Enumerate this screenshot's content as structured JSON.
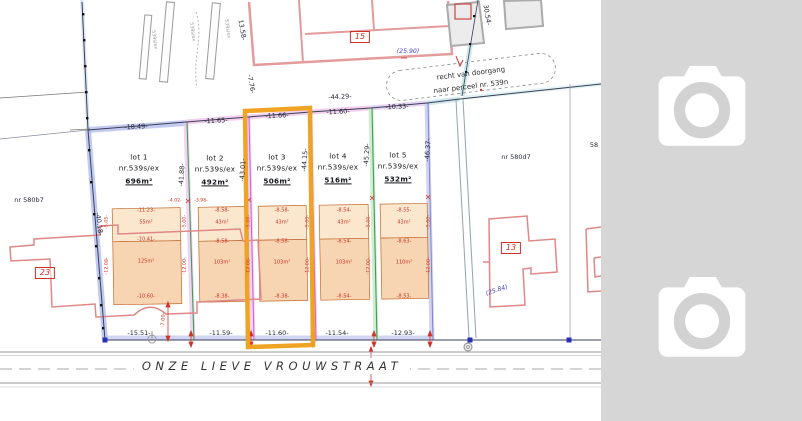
{
  "street": {
    "name": "ONZE LIEVE VROUWSTRAAT"
  },
  "panel": {
    "background": "#d6d6d6",
    "placeholder_icon": "camera-icon",
    "placeholder_count": 2
  },
  "highlight": {
    "color": "#f0a11c",
    "target": "lot 3"
  },
  "right_of_way": {
    "line1": "recht van doorgang",
    "line2": "naar perceel nr. 539n"
  },
  "neighbors": {
    "left_parcel": "nr 580b7",
    "right_parcel": "nr 580d7",
    "clipped_parcel": "58",
    "house_numbers": [
      "15",
      "23",
      "13"
    ]
  },
  "notes_blue": [
    "(25.90)",
    "(25.84)"
  ],
  "lots": [
    {
      "label": "lot 1",
      "parcel": "nr.539s/ex",
      "area": "696m²",
      "front_top": "-18.49-",
      "front_bottom": "-15.51-",
      "side": "-41.88-",
      "build_upper_width": "-11.23-",
      "build_upper_area": "55m²",
      "build_mid_width": "-10.41-",
      "build_main_area": "125m²",
      "build_bottom_width": "-10.60-"
    },
    {
      "label": "lot 2",
      "parcel": "nr.539s/ex",
      "area": "492m²",
      "front_top": "-11.65-",
      "front_bottom": "-11.59-",
      "side": "-43.01-",
      "build_upper_width": "-8.58-",
      "build_upper_area": "43m²",
      "build_mid_width": "-8.58-",
      "build_main_area": "103m²",
      "build_bottom_width": "-8.38-"
    },
    {
      "label": "lot 3",
      "parcel": "nr.539s/ex",
      "area": "506m²",
      "front_top": "-11.66-",
      "front_bottom": "-11.60-",
      "side": "-44.15-",
      "build_upper_width": "-8.58-",
      "build_upper_area": "43m²",
      "build_mid_width": "-8.58-",
      "build_main_area": "103m²",
      "build_bottom_width": "-8.38-",
      "highlighted": true
    },
    {
      "label": "lot 4",
      "parcel": "nr.539s/ex",
      "area": "516m²",
      "front_top": "-11.60-",
      "front_bottom": "-11.54-",
      "side": "-45.29-",
      "build_upper_width": "-8.54-",
      "build_upper_area": "43m²",
      "build_mid_width": "-8.54-",
      "build_main_area": "103m²",
      "build_bottom_width": "-8.54-"
    },
    {
      "label": "lot 5",
      "parcel": "nr.539s/ex",
      "area": "532m²",
      "front_top": "-10.33-",
      "front_bottom": "-12.93-",
      "side": "-46.37-",
      "build_upper_width": "-8.55-",
      "build_upper_area": "43m²",
      "build_mid_width": "-8.63-",
      "build_main_area": "110m²",
      "build_bottom_width": "-8.53-"
    }
  ],
  "boundary_dims": [
    "-44.29-",
    "-40.18-",
    "13.58-",
    "-7.76-",
    "30.54-"
  ],
  "plan": {
    "labels": [
      {
        "id": "dim-top-lot1",
        "t": "-18.49-",
        "x": 136,
        "y": 127,
        "s": 6.5,
        "c": "dim",
        "r": -3
      },
      {
        "id": "dim-top-lot2",
        "t": "-11.65-",
        "x": 216,
        "y": 121,
        "s": 6.5,
        "c": "dim",
        "r": -3
      },
      {
        "id": "dim-top-lot3",
        "t": "-11.66-",
        "x": 277,
        "y": 116,
        "s": 6.5,
        "c": "dim",
        "r": -3
      },
      {
        "id": "dim-top-lot4",
        "t": "-11.60-",
        "x": 338,
        "y": 112,
        "s": 6.5,
        "c": "dim",
        "r": -3
      },
      {
        "id": "dim-top-lot5",
        "t": "-10.33-",
        "x": 397,
        "y": 107,
        "s": 6.5,
        "c": "dim",
        "r": -3
      },
      {
        "id": "dim-top-total",
        "t": "-44.29-",
        "x": 340,
        "y": 97,
        "s": 6.5,
        "c": "dim",
        "r": -3
      },
      {
        "id": "dim-bottom-lot1",
        "t": "-15.51-",
        "x": 139,
        "y": 333,
        "s": 6.5,
        "c": "dim"
      },
      {
        "id": "dim-bottom-lot2",
        "t": "-11.59-",
        "x": 221,
        "y": 333,
        "s": 6.5,
        "c": "dim"
      },
      {
        "id": "dim-bottom-lot3",
        "t": "-11.60-",
        "x": 277,
        "y": 333,
        "s": 6.5,
        "c": "dim"
      },
      {
        "id": "dim-bottom-lot4",
        "t": "-11.54-",
        "x": 337,
        "y": 333,
        "s": 6.5,
        "c": "dim"
      },
      {
        "id": "dim-bottom-lot5",
        "t": "-12.93-",
        "x": 403,
        "y": 333,
        "s": 6.5,
        "c": "dim"
      },
      {
        "id": "dim-side-west",
        "t": "-40.18-",
        "x": 99,
        "y": 224,
        "s": 6.5,
        "c": "dim",
        "r": 82
      },
      {
        "id": "dim-side-d1",
        "t": "-41.88-",
        "x": 182,
        "y": 175,
        "s": 6.5,
        "c": "dim",
        "r": -86
      },
      {
        "id": "dim-side-d2",
        "t": "-43.01-",
        "x": 243,
        "y": 170,
        "s": 6.5,
        "c": "dim",
        "r": -86
      },
      {
        "id": "dim-side-d3",
        "t": "-44.15-",
        "x": 305,
        "y": 160,
        "s": 6.5,
        "c": "dim",
        "r": -86
      },
      {
        "id": "dim-side-d4",
        "t": "-45.29-",
        "x": 367,
        "y": 155,
        "s": 6.5,
        "c": "dim",
        "r": -86
      },
      {
        "id": "dim-side-d5",
        "t": "-46.37-",
        "x": 428,
        "y": 150,
        "s": 6.5,
        "c": "dim",
        "r": -86
      },
      {
        "id": "dim-ne-1",
        "t": "13.58-",
        "x": 242,
        "y": 30,
        "s": 6.5,
        "c": "dim",
        "r": 80
      },
      {
        "id": "dim-ne-2",
        "t": "-7.76-",
        "x": 251,
        "y": 84,
        "s": 6.5,
        "c": "dim",
        "r": 80
      },
      {
        "id": "dim-ne-3",
        "t": "30.54-",
        "x": 487,
        "y": 15,
        "s": 6.5,
        "c": "dim",
        "r": 80
      },
      {
        "id": "lot1-name",
        "t": "lot 1",
        "x": 139,
        "y": 157,
        "s": 7.2,
        "c": "lot"
      },
      {
        "id": "lot1-parcel",
        "t": "nr.539s/ex",
        "x": 139,
        "y": 168,
        "s": 7.2,
        "c": "lot"
      },
      {
        "id": "lot1-area",
        "t": "696m²",
        "x": 139,
        "y": 181,
        "s": 7.2,
        "c": "area"
      },
      {
        "id": "lot2-name",
        "t": "lot 2",
        "x": 215,
        "y": 158,
        "s": 7.2,
        "c": "lot"
      },
      {
        "id": "lot2-parcel",
        "t": "nr.539s/ex",
        "x": 215,
        "y": 169,
        "s": 7.2,
        "c": "lot"
      },
      {
        "id": "lot2-area",
        "t": "492m²",
        "x": 215,
        "y": 182,
        "s": 7.2,
        "c": "area"
      },
      {
        "id": "lot3-name",
        "t": "lot 3",
        "x": 277,
        "y": 157,
        "s": 7.2,
        "c": "lot"
      },
      {
        "id": "lot3-parcel",
        "t": "nr.539s/ex",
        "x": 277,
        "y": 168,
        "s": 7.2,
        "c": "lot"
      },
      {
        "id": "lot3-area",
        "t": "506m²",
        "x": 277,
        "y": 181,
        "s": 7.2,
        "c": "area"
      },
      {
        "id": "lot4-name",
        "t": "lot 4",
        "x": 338,
        "y": 156,
        "s": 7.2,
        "c": "lot"
      },
      {
        "id": "lot4-parcel",
        "t": "nr.539s/ex",
        "x": 338,
        "y": 167,
        "s": 7.2,
        "c": "lot"
      },
      {
        "id": "lot4-area",
        "t": "516m²",
        "x": 338,
        "y": 180,
        "s": 7.2,
        "c": "area"
      },
      {
        "id": "lot5-name",
        "t": "lot 5",
        "x": 398,
        "y": 155,
        "s": 7.2,
        "c": "lot"
      },
      {
        "id": "lot5-parcel",
        "t": "nr.539s/ex",
        "x": 398,
        "y": 166,
        "s": 7.2,
        "c": "lot"
      },
      {
        "id": "lot5-area",
        "t": "532m²",
        "x": 398,
        "y": 179,
        "s": 7.2,
        "c": "area"
      },
      {
        "id": "parcel-580b7",
        "t": "nr 580b7",
        "x": 29,
        "y": 200,
        "s": 6.5,
        "c": "dim"
      },
      {
        "id": "parcel-580d7",
        "t": "nr 580d7",
        "x": 516,
        "y": 157,
        "s": 6.5,
        "c": "dim"
      },
      {
        "id": "parcel-clipped",
        "t": "58",
        "x": 594,
        "y": 145,
        "s": 6.5,
        "c": "dim"
      },
      {
        "id": "house-15",
        "t": "15",
        "x": 360,
        "y": 37,
        "s": 8,
        "c": "box"
      },
      {
        "id": "house-23",
        "t": "23",
        "x": 45,
        "y": 273,
        "s": 8,
        "c": "box"
      },
      {
        "id": "house-13",
        "t": "13",
        "x": 511,
        "y": 248,
        "s": 8,
        "c": "box"
      },
      {
        "id": "note-2590",
        "t": "(25.90)",
        "x": 408,
        "y": 52,
        "s": 6.2,
        "c": "blue"
      },
      {
        "id": "note-2584",
        "t": "(25.84)",
        "x": 497,
        "y": 291,
        "s": 6.2,
        "c": "blue",
        "r": -18
      },
      {
        "id": "row-line1",
        "t": "recht van doorgang",
        "x": 471,
        "y": 74,
        "s": 7,
        "c": "row",
        "r": -7
      },
      {
        "id": "row-line2",
        "t": "naar perceel nr. 539n",
        "x": 471,
        "y": 87,
        "s": 7,
        "c": "row",
        "r": -7
      },
      {
        "id": "fp1-top",
        "t": "-11.23-",
        "x": 146,
        "y": 211,
        "s": 5,
        "c": "red"
      },
      {
        "id": "fp1-area-top",
        "t": "55m²",
        "x": 146,
        "y": 223,
        "s": 5,
        "c": "red"
      },
      {
        "id": "fp1-mid",
        "t": "-10.41-",
        "x": 146,
        "y": 240,
        "s": 5,
        "c": "red"
      },
      {
        "id": "fp1-area-main",
        "t": "125m²",
        "x": 146,
        "y": 262,
        "s": 5,
        "c": "red"
      },
      {
        "id": "fp1-bottom",
        "t": "-10.60-",
        "x": 146,
        "y": 297,
        "s": 5,
        "c": "red"
      },
      {
        "id": "fp2-top",
        "t": "-8.58-",
        "x": 222,
        "y": 211,
        "s": 5,
        "c": "red"
      },
      {
        "id": "fp2-area-top",
        "t": "43m²",
        "x": 222,
        "y": 223,
        "s": 5,
        "c": "red"
      },
      {
        "id": "fp2-mid",
        "t": "-8.58-",
        "x": 222,
        "y": 242,
        "s": 5,
        "c": "red"
      },
      {
        "id": "fp2-area-main",
        "t": "103m²",
        "x": 222,
        "y": 263,
        "s": 5,
        "c": "red"
      },
      {
        "id": "fp2-bottom",
        "t": "-8.38-",
        "x": 222,
        "y": 297,
        "s": 5,
        "c": "red"
      },
      {
        "id": "fp3-top",
        "t": "-8.58-",
        "x": 282,
        "y": 211,
        "s": 5,
        "c": "red"
      },
      {
        "id": "fp3-area-top",
        "t": "43m²",
        "x": 282,
        "y": 223,
        "s": 5,
        "c": "red"
      },
      {
        "id": "fp3-mid",
        "t": "-8.58-",
        "x": 282,
        "y": 242,
        "s": 5,
        "c": "red"
      },
      {
        "id": "fp3-area-main",
        "t": "103m²",
        "x": 282,
        "y": 263,
        "s": 5,
        "c": "red"
      },
      {
        "id": "fp3-bottom",
        "t": "-8.38-",
        "x": 282,
        "y": 297,
        "s": 5,
        "c": "red"
      },
      {
        "id": "fp4-top",
        "t": "-8.54-",
        "x": 344,
        "y": 211,
        "s": 5,
        "c": "red"
      },
      {
        "id": "fp4-area-top",
        "t": "43m²",
        "x": 344,
        "y": 223,
        "s": 5,
        "c": "red"
      },
      {
        "id": "fp4-mid",
        "t": "-8.54-",
        "x": 344,
        "y": 242,
        "s": 5,
        "c": "red"
      },
      {
        "id": "fp4-area-main",
        "t": "103m²",
        "x": 344,
        "y": 263,
        "s": 5,
        "c": "red"
      },
      {
        "id": "fp4-bottom",
        "t": "-8.54-",
        "x": 344,
        "y": 297,
        "s": 5,
        "c": "red"
      },
      {
        "id": "fp5-top",
        "t": "-8.55-",
        "x": 404,
        "y": 211,
        "s": 5,
        "c": "red"
      },
      {
        "id": "fp5-area-top",
        "t": "43m²",
        "x": 404,
        "y": 223,
        "s": 5,
        "c": "red"
      },
      {
        "id": "fp5-mid",
        "t": "-8.63-",
        "x": 404,
        "y": 242,
        "s": 5,
        "c": "red"
      },
      {
        "id": "fp5-area-main",
        "t": "110m²",
        "x": 404,
        "y": 263,
        "s": 5,
        "c": "red"
      },
      {
        "id": "fp5-bottom",
        "t": "-8.53-",
        "x": 404,
        "y": 297,
        "s": 5,
        "c": "red"
      },
      {
        "id": "fp1-side-l1",
        "t": "-5.05-",
        "x": 108,
        "y": 222,
        "s": 4.8,
        "c": "red",
        "r": -88
      },
      {
        "id": "fp1-side-l2",
        "t": "-12.08-",
        "x": 108,
        "y": 266,
        "s": 4.8,
        "c": "red",
        "r": -88
      },
      {
        "id": "fp1-side-r1",
        "t": "-5.00-",
        "x": 186,
        "y": 222,
        "s": 4.8,
        "c": "red",
        "r": -88
      },
      {
        "id": "fp1-side-r2",
        "t": "-12.00-",
        "x": 186,
        "y": 266,
        "s": 4.8,
        "c": "red",
        "r": -88
      },
      {
        "id": "fp2-side-r1",
        "t": "-5.00-",
        "x": 250,
        "y": 222,
        "s": 4.8,
        "c": "red",
        "r": -88
      },
      {
        "id": "fp2-side-r2",
        "t": "-12.00-",
        "x": 250,
        "y": 266,
        "s": 4.8,
        "c": "red",
        "r": -88
      },
      {
        "id": "fp3-side-r1",
        "t": "-5.00-",
        "x": 309,
        "y": 222,
        "s": 4.8,
        "c": "red",
        "r": -88
      },
      {
        "id": "fp3-side-r2",
        "t": "-12.00-",
        "x": 309,
        "y": 266,
        "s": 4.8,
        "c": "red",
        "r": -88
      },
      {
        "id": "fp4-side-r1",
        "t": "-5.00-",
        "x": 370,
        "y": 222,
        "s": 4.8,
        "c": "red",
        "r": -88
      },
      {
        "id": "fp4-side-r2",
        "t": "-12.00-",
        "x": 370,
        "y": 266,
        "s": 4.8,
        "c": "red",
        "r": -88
      },
      {
        "id": "fp5-side-r1",
        "t": "-5.00-",
        "x": 430,
        "y": 222,
        "s": 4.8,
        "c": "red",
        "r": -88
      },
      {
        "id": "fp5-side-r2",
        "t": "-12.00-",
        "x": 430,
        "y": 266,
        "s": 4.8,
        "c": "red",
        "r": -88
      },
      {
        "id": "setback-dim",
        "t": "-7.00-",
        "x": 164,
        "y": 320,
        "s": 5,
        "c": "red",
        "r": -88
      },
      {
        "id": "split-dim-a",
        "t": "-4.02-",
        "x": 175,
        "y": 202,
        "s": 4.6,
        "c": "red"
      },
      {
        "id": "split-dim-b",
        "t": "-3.98-",
        "x": 201,
        "y": 202,
        "s": 4.6,
        "c": "red"
      },
      {
        "id": "strip-label-1",
        "t": "539s/ex",
        "x": 153,
        "y": 40,
        "s": 4.8,
        "c": "gray",
        "r": 82
      },
      {
        "id": "strip-label-2",
        "t": "539s/ex",
        "x": 191,
        "y": 32,
        "s": 4.8,
        "c": "gray",
        "r": 82
      },
      {
        "id": "strip-label-3",
        "t": "539s/ex",
        "x": 226,
        "y": 29,
        "s": 4.8,
        "c": "gray",
        "r": 82
      }
    ]
  }
}
